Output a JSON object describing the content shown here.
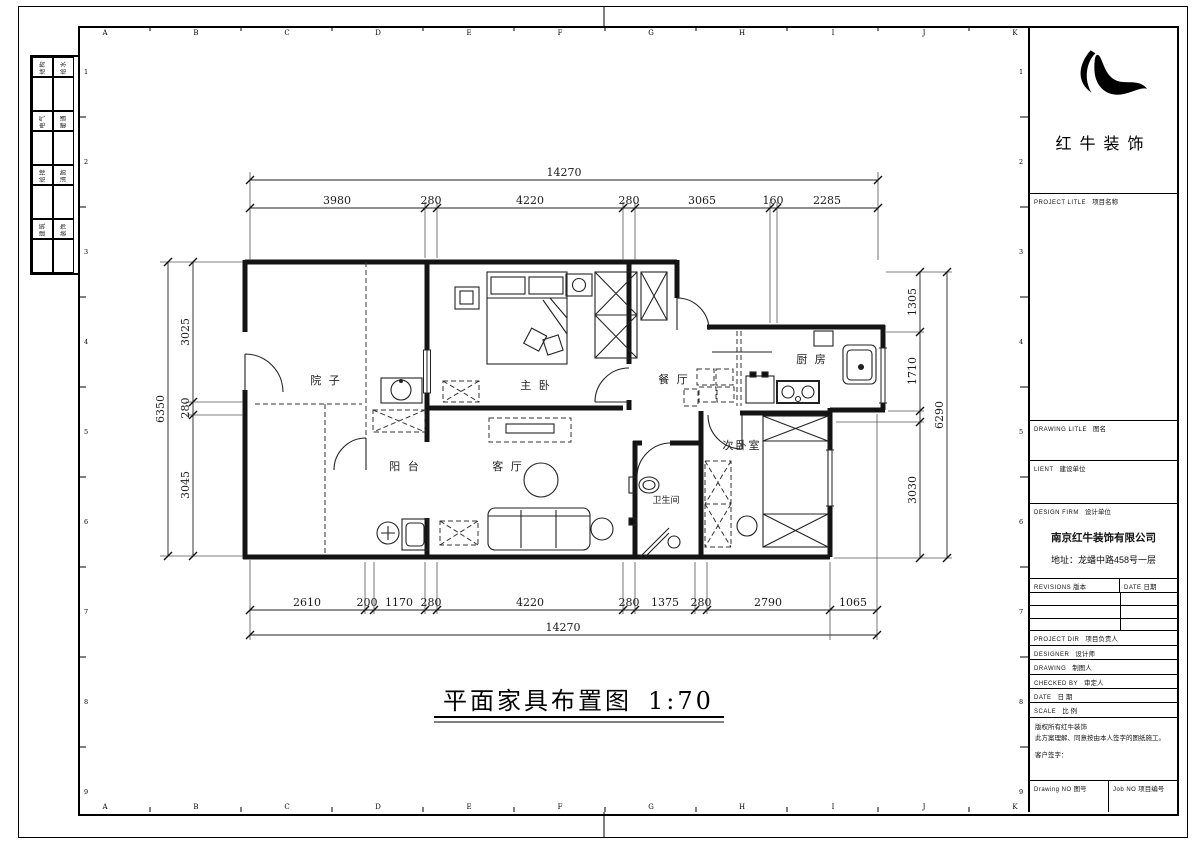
{
  "sheet": {
    "brand": "红牛装饰",
    "title": "平面家具布置图",
    "scale_label": "1:70"
  },
  "rulers": {
    "letters": [
      "A",
      "B",
      "C",
      "D",
      "E",
      "F",
      "G",
      "H",
      "I",
      "J",
      "K"
    ],
    "numbers": [
      "1",
      "2",
      "3",
      "4",
      "5",
      "6",
      "7",
      "8",
      "9"
    ]
  },
  "signoff": {
    "cells": [
      "结构",
      "给水",
      "电气",
      "暖通",
      "给排",
      "消防",
      "建筑",
      "装饰"
    ]
  },
  "plan": {
    "rooms": {
      "courtyard": "院 子",
      "master": "主 卧",
      "dining": "餐 厅",
      "kitchen": "厨 房",
      "balcony": "阳 台",
      "living": "客 厅",
      "bedroom2": "次卧室",
      "bath": "卫生间"
    },
    "dims": {
      "top_total": "14270",
      "top": [
        "3980",
        "280",
        "4220",
        "280",
        "3065",
        "160",
        "2285"
      ],
      "bottom": [
        "2610",
        "200",
        "1170",
        "280",
        "4220",
        "280",
        "1375",
        "280",
        "2790",
        "1065"
      ],
      "bottom_total": "14270",
      "left": [
        "3025",
        "280",
        "3045"
      ],
      "left_total": "6350",
      "right": [
        "1305",
        "1710",
        "3030"
      ],
      "right_total": "6290"
    }
  },
  "titleblock": {
    "project": {
      "en": "PROJECT LITLE",
      "cn": "项目名称"
    },
    "drawing_title": {
      "en": "DRAWING LITLE",
      "cn": "图名"
    },
    "client": {
      "en": "LIENT",
      "cn": "建设单位"
    },
    "design_firm": {
      "en": "DESIGN FIRM",
      "cn": "设计单位"
    },
    "firm_name": "南京红牛装饰有限公司",
    "firm_address": "地址：龙蟠中路458号一层",
    "revisions": {
      "en": "REVISIONS",
      "cn": "版本"
    },
    "rev_date": {
      "en": "DATE",
      "cn": "日期"
    },
    "project_dir": {
      "en": "PROJECT DIR",
      "cn": "项目负责人"
    },
    "designer": {
      "en": "DESIGNER",
      "cn": "设计师"
    },
    "drawing_by": {
      "en": "DRAWING",
      "cn": "制图人"
    },
    "checked_by": {
      "en": "CHECKED BY",
      "cn": "审定人"
    },
    "date": {
      "en": "DATE",
      "cn": "日 期"
    },
    "scale": {
      "en": "SCALE",
      "cn": "比 例"
    },
    "copyright1": "版权所有红牛装饰",
    "copyright2": "此方案理解、同意按由本人签字的图纸施工。",
    "signature": "客户签字：",
    "drawing_no": {
      "en": "Drawing NO",
      "cn": "图号"
    },
    "job_no": {
      "en": "Job NO",
      "cn": "项目编号"
    }
  }
}
